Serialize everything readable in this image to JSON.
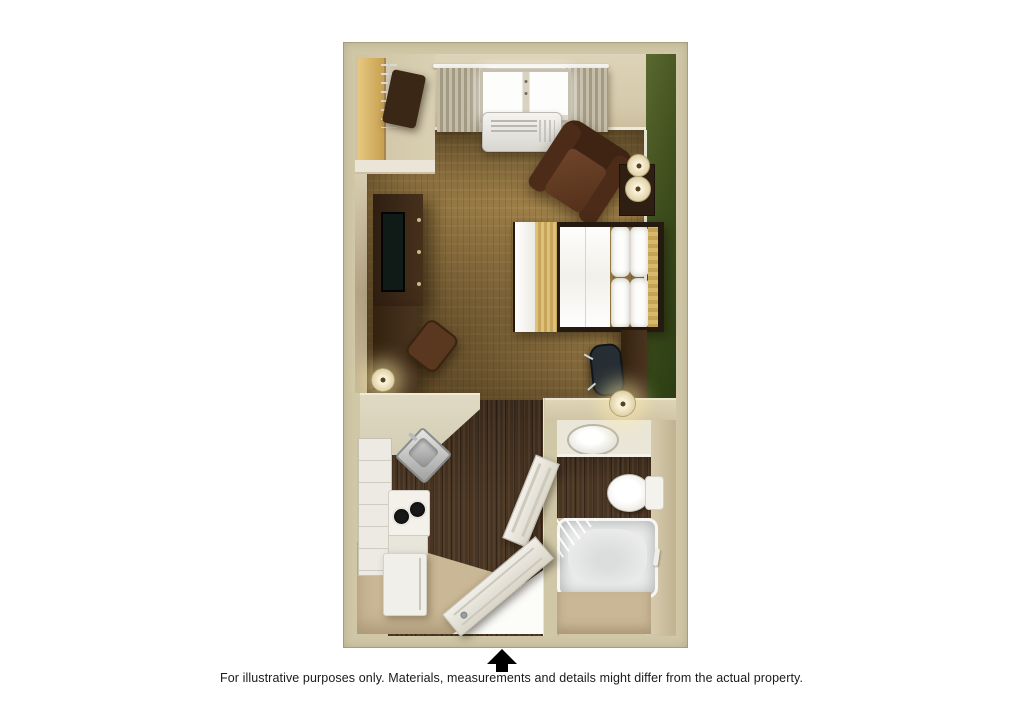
{
  "caption": {
    "text": "For illustrative purposes only.  Materials, measurements and details might differ from the actual property."
  },
  "compass": {
    "icon": "up-arrow-icon"
  },
  "floorplan": {
    "type": "3d-top-down-studio-room-rendering",
    "rooms": [
      {
        "name": "living-sleeping-area"
      },
      {
        "name": "closet"
      },
      {
        "name": "kitchenette"
      },
      {
        "name": "entry-hall"
      },
      {
        "name": "bathroom"
      }
    ],
    "furniture": [
      "wardrobe-shelf",
      "hanging-clothes",
      "window-with-curtains",
      "ptac-air-conditioner",
      "armchair",
      "nightstand",
      "table-lamps",
      "queen-bed",
      "tv-console",
      "television",
      "writing-desk",
      "desk-chair",
      "office-chair",
      "kitchen-counter",
      "kitchen-sink",
      "two-burner-stove",
      "dishwasher",
      "refrigerator",
      "bathroom-vanity-sink",
      "toilet",
      "bathtub-with-shower-curtain",
      "entry-door",
      "bathroom-door",
      "towel-bar"
    ],
    "colors": {
      "background": "#ffffff",
      "wall_border": "#cfc7a6",
      "wall_face": "#d9cfb2",
      "accent_wall_green": "#3e4e1d",
      "carpet": "#9d7e47",
      "dark_wood_floor": "#4a3522",
      "entry_floor": "#c9b795",
      "counter_beige": "#d4cdb5",
      "fixture_white": "#eceae3",
      "furniture_dark_brown": "#38261a",
      "bedding_white": "#f8f7f3",
      "bed_runner_gold": "#d4b468",
      "arrow_black": "#000000",
      "caption_text": "#1a1a1a"
    }
  }
}
